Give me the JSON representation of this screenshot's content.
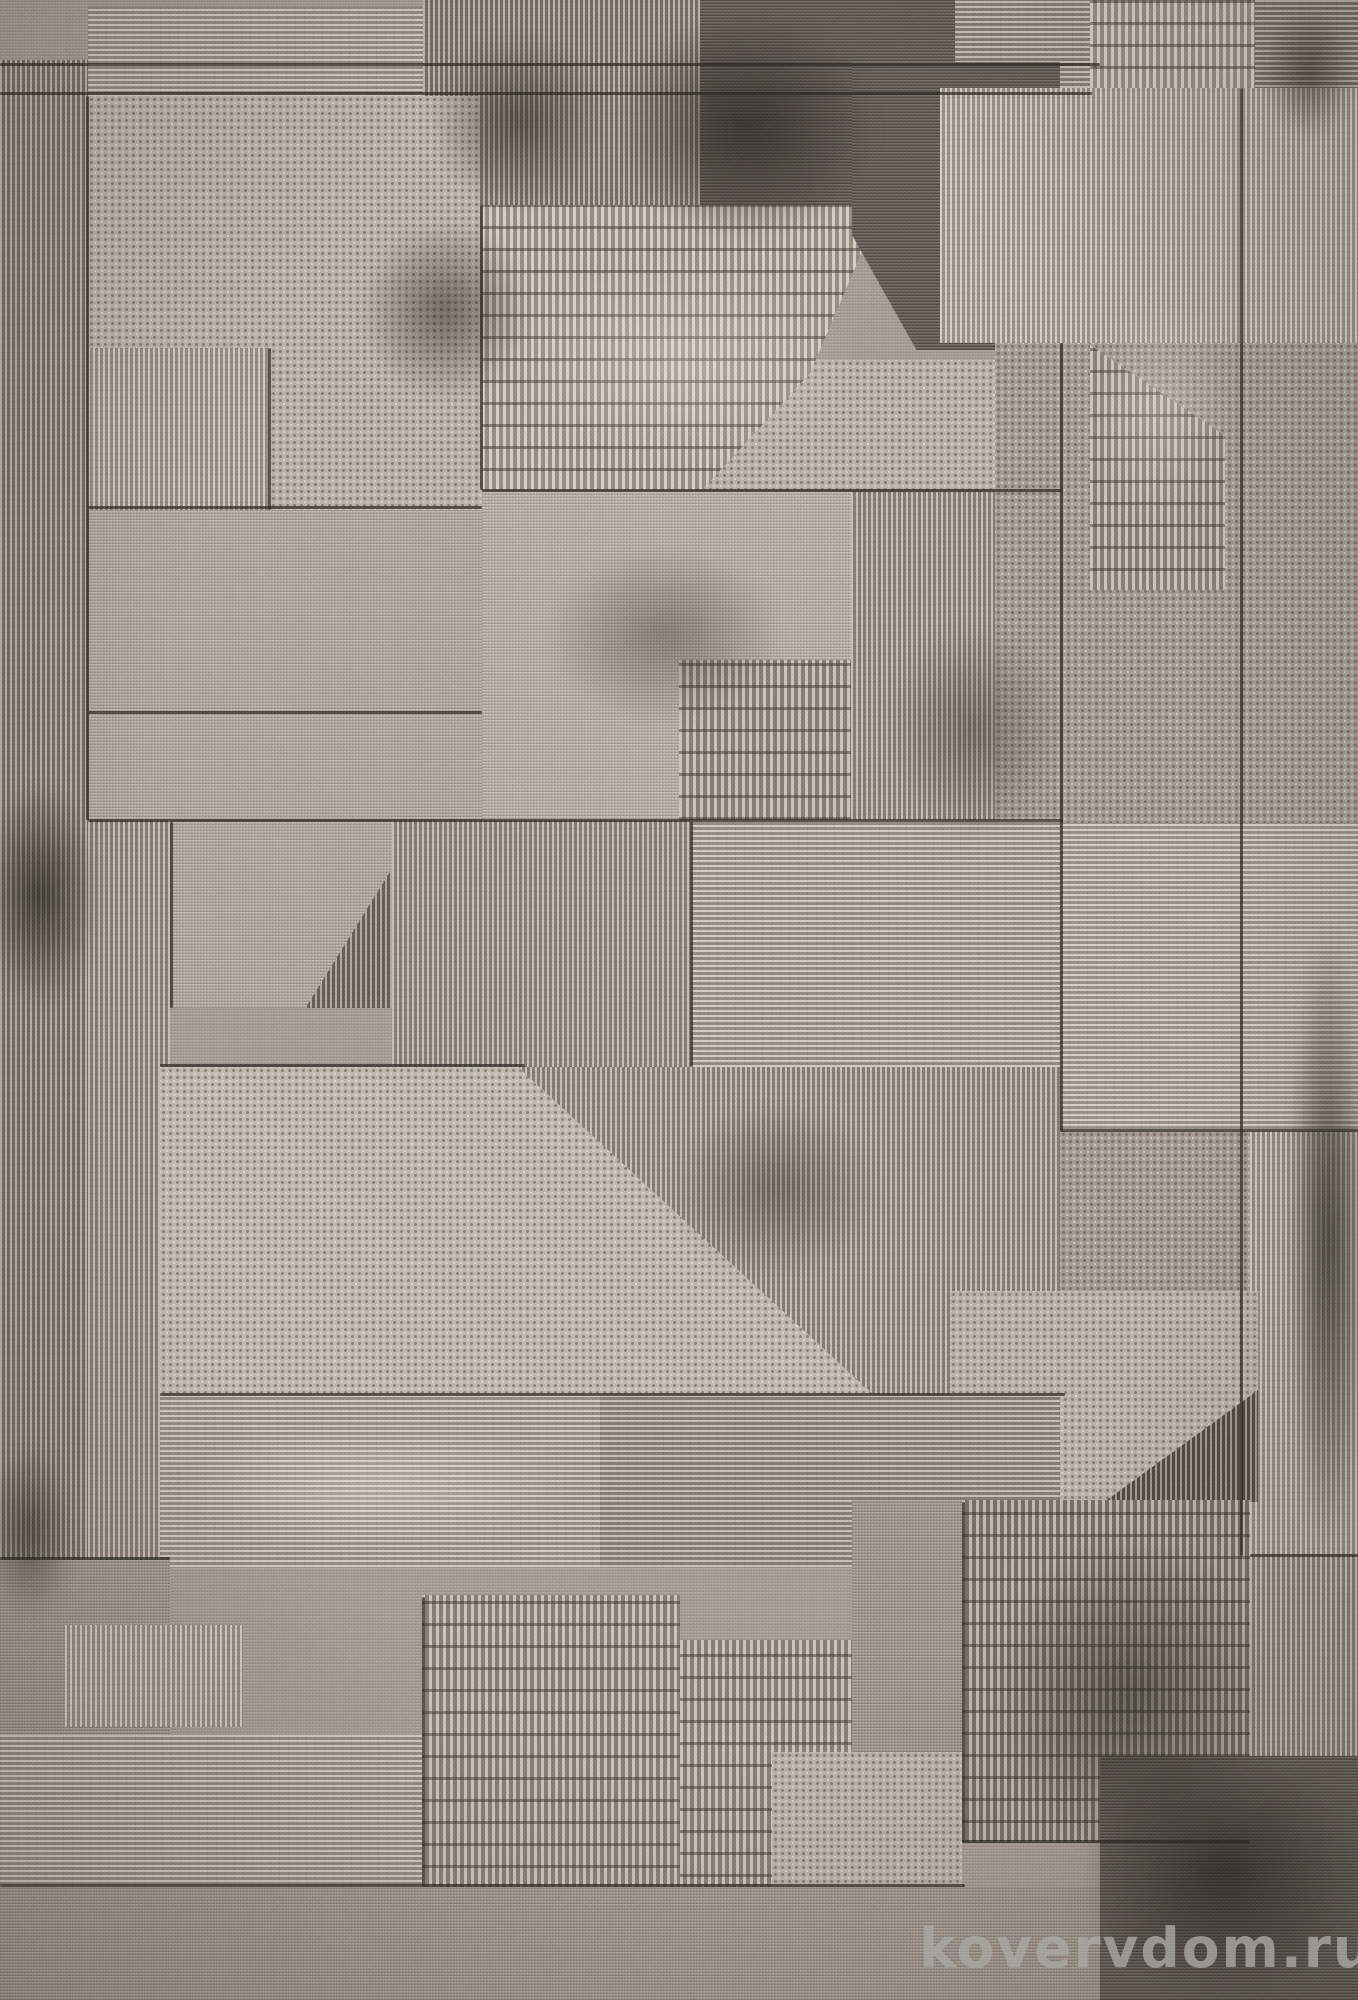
{
  "photo": {
    "subject": "rug-carpet-geometric-patchwork",
    "width": 1358,
    "height": 2000
  },
  "watermark": {
    "text": "kovervdom.ru",
    "color": "#aaa8a5"
  },
  "palette": {
    "base": "#aba199",
    "light": "#b9b0a7",
    "light2": "#c0b8ae",
    "mid": "#a49a91",
    "middark": "#8d847b",
    "dark": "#766d66",
    "charcoal": "#574f4a",
    "seam": "#2a2521"
  },
  "patches": [
    {
      "x": 0,
      "y": 60,
      "w": 88,
      "h": 1945,
      "t": "vrib",
      "s": "middark"
    },
    {
      "x": 88,
      "y": 6,
      "w": 335,
      "h": 90,
      "t": "hline",
      "s": "light"
    },
    {
      "x": 423,
      "y": 0,
      "w": 277,
      "h": 205,
      "t": "vrib",
      "s": "middark"
    },
    {
      "x": 700,
      "y": 0,
      "w": 255,
      "h": 235,
      "t": "mesh",
      "s": "char"
    },
    {
      "x": 955,
      "y": 0,
      "w": 135,
      "h": 88,
      "t": "hline",
      "s": "mid"
    },
    {
      "x": 1090,
      "y": 0,
      "w": 165,
      "h": 88,
      "t": "dash",
      "s": "light"
    },
    {
      "x": 1255,
      "y": 0,
      "w": 103,
      "h": 142,
      "t": "hline",
      "s": "middark"
    },
    {
      "x": 88,
      "y": 96,
      "w": 392,
      "h": 252,
      "t": "diamond",
      "s": "light"
    },
    {
      "x": 270,
      "y": 348,
      "w": 212,
      "h": 162,
      "t": "diamond",
      "s": "light"
    },
    {
      "x": 88,
      "y": 348,
      "w": 182,
      "h": 162,
      "t": "vrib",
      "s": "light"
    },
    {
      "x": 88,
      "y": 510,
      "w": 394,
      "h": 310,
      "t": "mesh",
      "s": "light"
    },
    {
      "x": 700,
      "y": 360,
      "w": 360,
      "h": 130,
      "t": "diamond",
      "s": "light"
    },
    {
      "x": 482,
      "y": 205,
      "w": 400,
      "h": 285,
      "t": "dash",
      "s": "light",
      "clip": "polygon(0 0,100% 0,82% 59%,55% 100%,0 100%)"
    },
    {
      "x": 852,
      "y": 62,
      "w": 208,
      "h": 288,
      "t": "mesh",
      "s": "char",
      "clip": "polygon(0 0,100% 0,100% 100%,31% 100%,0 60%)"
    },
    {
      "x": 940,
      "y": 88,
      "w": 300,
      "h": 255,
      "t": "vrib",
      "s": "light2"
    },
    {
      "x": 1240,
      "y": 88,
      "w": 118,
      "h": 255,
      "t": "vrib",
      "s": "light2"
    },
    {
      "x": 995,
      "y": 343,
      "w": 245,
      "h": 480,
      "t": "diamond",
      "s": "mid"
    },
    {
      "x": 1090,
      "y": 345,
      "w": 135,
      "h": 245,
      "t": "dash",
      "s": "mid",
      "clip": "polygon(0 0,100% 37%,100% 100%,0 100%)"
    },
    {
      "x": 1240,
      "y": 343,
      "w": 118,
      "h": 480,
      "t": "diamond",
      "s": "mid"
    },
    {
      "x": 482,
      "y": 492,
      "w": 372,
      "h": 330,
      "t": "mesh",
      "s": "light2"
    },
    {
      "x": 679,
      "y": 660,
      "w": 172,
      "h": 245,
      "t": "dash",
      "s": "mid"
    },
    {
      "x": 851,
      "y": 492,
      "w": 144,
      "h": 330,
      "t": "vrib",
      "s": "mid"
    },
    {
      "x": 88,
      "y": 820,
      "w": 82,
      "h": 745,
      "t": "vrib",
      "s": "mid"
    },
    {
      "x": 170,
      "y": 822,
      "w": 222,
      "h": 186,
      "t": "vrib",
      "s": "dark"
    },
    {
      "x": 170,
      "y": 822,
      "w": 222,
      "h": 186,
      "t": "mesh",
      "s": "light",
      "clip": "polygon(0 0,100% 0,100% 25%,61% 100%,0 100%)"
    },
    {
      "x": 392,
      "y": 820,
      "w": 298,
      "h": 247,
      "t": "vrib",
      "s": "mid"
    },
    {
      "x": 690,
      "y": 820,
      "w": 370,
      "h": 247,
      "t": "hline",
      "s": "light"
    },
    {
      "x": 1060,
      "y": 823,
      "w": 298,
      "h": 308,
      "t": "hline",
      "s": "light2"
    },
    {
      "x": 520,
      "y": 1067,
      "w": 540,
      "h": 328,
      "t": "vrib",
      "s": "mid"
    },
    {
      "x": 160,
      "y": 1067,
      "w": 716,
      "h": 330,
      "t": "diamond",
      "s": "light2",
      "clip": "polygon(0 0,50% 0,100% 100%,0 100%)"
    },
    {
      "x": 1060,
      "y": 1131,
      "w": 190,
      "h": 160,
      "t": "diamond",
      "s": "mid"
    },
    {
      "x": 1250,
      "y": 1131,
      "w": 108,
      "h": 425,
      "t": "vrib",
      "s": "light"
    },
    {
      "x": 1080,
      "y": 1380,
      "w": 178,
      "h": 122,
      "t": "vrib",
      "s": "char"
    },
    {
      "x": 950,
      "y": 1291,
      "w": 308,
      "h": 211,
      "t": "diamond",
      "s": "light",
      "clip": "polygon(0 0,100% 0,100% 47%,50% 100%,0 100%)"
    },
    {
      "x": 160,
      "y": 1395,
      "w": 440,
      "h": 172,
      "t": "hline",
      "s": "light"
    },
    {
      "x": 600,
      "y": 1395,
      "w": 460,
      "h": 172,
      "t": "hline",
      "s": "mid"
    },
    {
      "x": 0,
      "y": 1560,
      "w": 170,
      "h": 330,
      "t": "mesh",
      "s": "mid"
    },
    {
      "x": 65,
      "y": 1625,
      "w": 178,
      "h": 102,
      "t": "vrib",
      "s": "light"
    },
    {
      "x": 0,
      "y": 1735,
      "w": 422,
      "h": 152,
      "t": "hline",
      "s": "light"
    },
    {
      "x": 422,
      "y": 1595,
      "w": 258,
      "h": 292,
      "t": "dash",
      "s": "mid"
    },
    {
      "x": 680,
      "y": 1640,
      "w": 172,
      "h": 322,
      "t": "dash",
      "s": "mid",
      "clip": "polygon(0 0,100% 0,100% 34%,58% 100%,0 100%)"
    },
    {
      "x": 772,
      "y": 1752,
      "w": 190,
      "h": 210,
      "t": "diamond",
      "s": "light"
    },
    {
      "x": 852,
      "y": 1500,
      "w": 250,
      "h": 252,
      "t": "mesh",
      "s": "mid"
    },
    {
      "x": 962,
      "y": 1500,
      "w": 288,
      "h": 342,
      "t": "dash",
      "s": "middark"
    },
    {
      "x": 1250,
      "y": 1556,
      "w": 108,
      "h": 200,
      "t": "vrib",
      "s": "mid"
    },
    {
      "x": 0,
      "y": 1887,
      "w": 1358,
      "h": 113,
      "t": "mesh",
      "s": "mid"
    },
    {
      "x": 1100,
      "y": 1756,
      "w": 258,
      "h": 244,
      "t": "mesh",
      "s": "char"
    }
  ],
  "seams": [
    {
      "x": 0,
      "y": 63,
      "w": 1100,
      "h": 3
    },
    {
      "x": 0,
      "y": 92,
      "w": 1092,
      "h": 3
    },
    {
      "x": 482,
      "y": 489,
      "w": 580,
      "h": 3
    },
    {
      "x": 88,
      "y": 819,
      "w": 975,
      "h": 3
    },
    {
      "x": 160,
      "y": 1064,
      "w": 365,
      "h": 3
    },
    {
      "x": 160,
      "y": 1393,
      "w": 905,
      "h": 3
    },
    {
      "x": 0,
      "y": 1884,
      "w": 965,
      "h": 3
    },
    {
      "x": 1060,
      "y": 1129,
      "w": 298,
      "h": 3
    },
    {
      "x": 88,
      "y": 506,
      "w": 394,
      "h": 3
    },
    {
      "x": 88,
      "y": 711,
      "w": 394,
      "h": 3
    },
    {
      "x": 0,
      "y": 1557,
      "w": 170,
      "h": 3
    },
    {
      "x": 1250,
      "y": 1554,
      "w": 108,
      "h": 3
    },
    {
      "x": 962,
      "y": 1840,
      "w": 288,
      "h": 3
    },
    {
      "x": 86,
      "y": 96,
      "w": 3,
      "h": 724
    },
    {
      "x": 480,
      "y": 205,
      "w": 3,
      "h": 285
    },
    {
      "x": 268,
      "y": 348,
      "w": 3,
      "h": 162
    },
    {
      "x": 1060,
      "y": 343,
      "w": 3,
      "h": 788
    },
    {
      "x": 1240,
      "y": 88,
      "w": 3,
      "h": 1468
    },
    {
      "x": 690,
      "y": 822,
      "w": 3,
      "h": 245
    },
    {
      "x": 422,
      "y": 1597,
      "w": 3,
      "h": 290
    },
    {
      "x": 962,
      "y": 1502,
      "w": 3,
      "h": 340
    },
    {
      "x": 170,
      "y": 822,
      "w": 3,
      "h": 186
    }
  ],
  "blotches": [
    {
      "x": 612,
      "y": 10,
      "w": 270,
      "h": 230,
      "k": "strong"
    },
    {
      "x": 360,
      "y": 220,
      "w": 170,
      "h": 180,
      "k": "med"
    },
    {
      "x": 1262,
      "y": 0,
      "w": 96,
      "h": 140,
      "k": "med"
    },
    {
      "x": -20,
      "y": 780,
      "w": 120,
      "h": 230,
      "k": "strong"
    },
    {
      "x": 545,
      "y": 545,
      "w": 240,
      "h": 180,
      "k": "soft"
    },
    {
      "x": 1288,
      "y": 920,
      "w": 80,
      "h": 640,
      "k": "strong"
    },
    {
      "x": 990,
      "y": 1530,
      "w": 280,
      "h": 330,
      "k": "med"
    },
    {
      "x": 1080,
      "y": 1750,
      "w": 290,
      "h": 250,
      "k": "strong"
    },
    {
      "x": -15,
      "y": 1440,
      "w": 90,
      "h": 180,
      "k": "med"
    },
    {
      "x": 670,
      "y": 1100,
      "w": 210,
      "h": 180,
      "k": "soft"
    },
    {
      "x": 885,
      "y": 620,
      "w": 180,
      "h": 220,
      "k": "soft"
    },
    {
      "x": 430,
      "y": 30,
      "w": 180,
      "h": 180,
      "k": "med"
    }
  ],
  "highlights": [
    {
      "x": 500,
      "y": 260,
      "w": 360,
      "h": 200
    },
    {
      "x": 180,
      "y": 1420,
      "w": 400,
      "h": 130
    },
    {
      "x": 1080,
      "y": 300,
      "w": 160,
      "h": 220
    }
  ]
}
